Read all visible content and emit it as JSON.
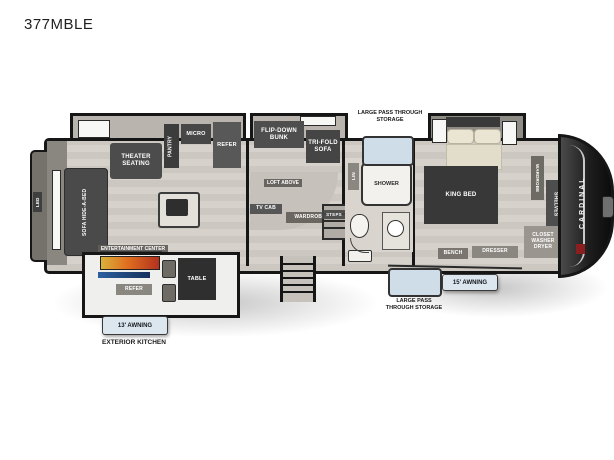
{
  "title": "377MBLE",
  "brand": "CARDINAL",
  "colors": {
    "wall": "#161616",
    "storage_door_blue": "#cfdde9",
    "flame_orange": "#e06f1f",
    "griddle_blue": "#2d5f9e",
    "floor_gray": "#d0ccc5"
  },
  "labels": {
    "rear_tv": "LED",
    "sofa": "SOFA HIDE-A-BED",
    "theater": "THEATER SEATING",
    "pantry": "PANTRY",
    "micro": "MICRO",
    "refer": "REFER",
    "entertainment": "ENTERTAINMENT CENTER",
    "flip_bunk": "FLIP-DOWN BUNK",
    "trifold": "TRI-FOLD SOFA",
    "loft": "LOFT ABOVE",
    "tv_cab": "TV CAB",
    "wardrobe_mid": "WARDROBE",
    "steps": "STEPS",
    "lin": "LIN",
    "shower": "SHOWER",
    "king_bed": "KING BED",
    "wardrobe_front": "WARDROBE",
    "shelves": "SHELVES",
    "closet_wd": "CLOSET WASHER DRYER",
    "bench": "BENCH",
    "dresser": "DRESSER",
    "storage_top": "LARGE PASS THROUGH STORAGE",
    "storage_bottom": "LARGE PASS THROUGH STORAGE",
    "awning_13": "13' AWNING",
    "awning_15": "15' AWNING",
    "ext_kitchen": "EXTERIOR KITCHEN",
    "ext_refer": "REFER",
    "table": "TABLE"
  }
}
